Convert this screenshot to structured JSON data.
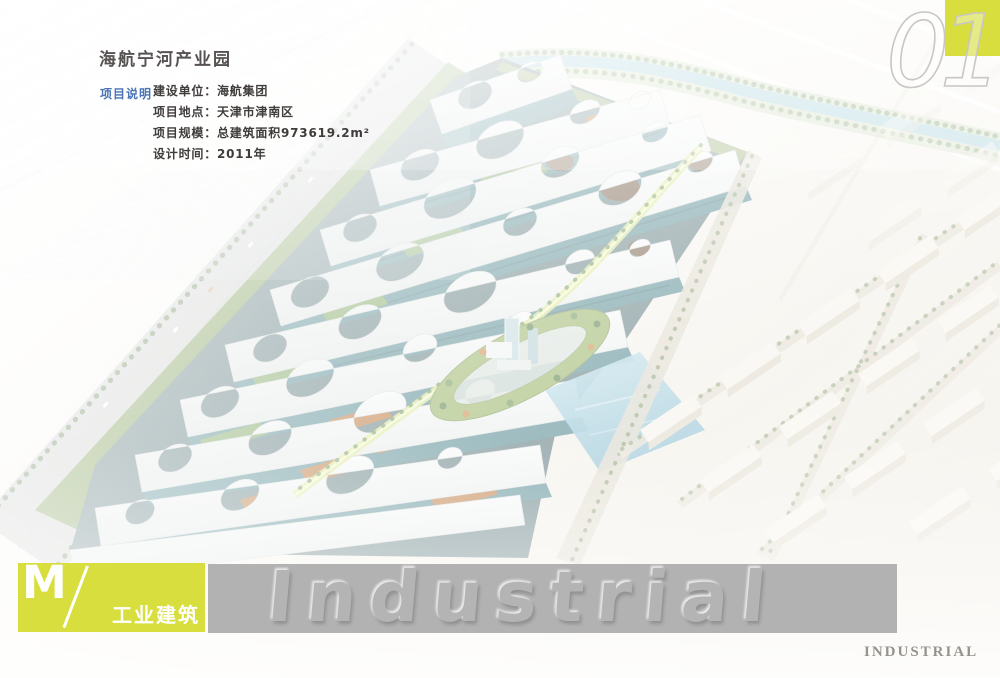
{
  "header": {
    "title": "海航宁河产业园",
    "section_label": "项目说明",
    "details": [
      "建设单位：海航集团",
      "项目地点：天津市津南区",
      "项目规模：总建筑面积973619.2m²",
      "设计时间：2011年"
    ]
  },
  "footer": {
    "logo_letter": "M",
    "category_label": "工业建筑",
    "watermark_text": "Industrial",
    "corner_label": "INDUSTRIAL"
  },
  "page_number": "01",
  "colors": {
    "accent_yellow_green": "#d7de3d",
    "section_label_blue": "#4a74b6",
    "title_gray": "#575352",
    "body_text_gray": "#403c3b",
    "watermark_band_gray": "#b3b2b2",
    "corner_label_gray": "#96928d"
  }
}
